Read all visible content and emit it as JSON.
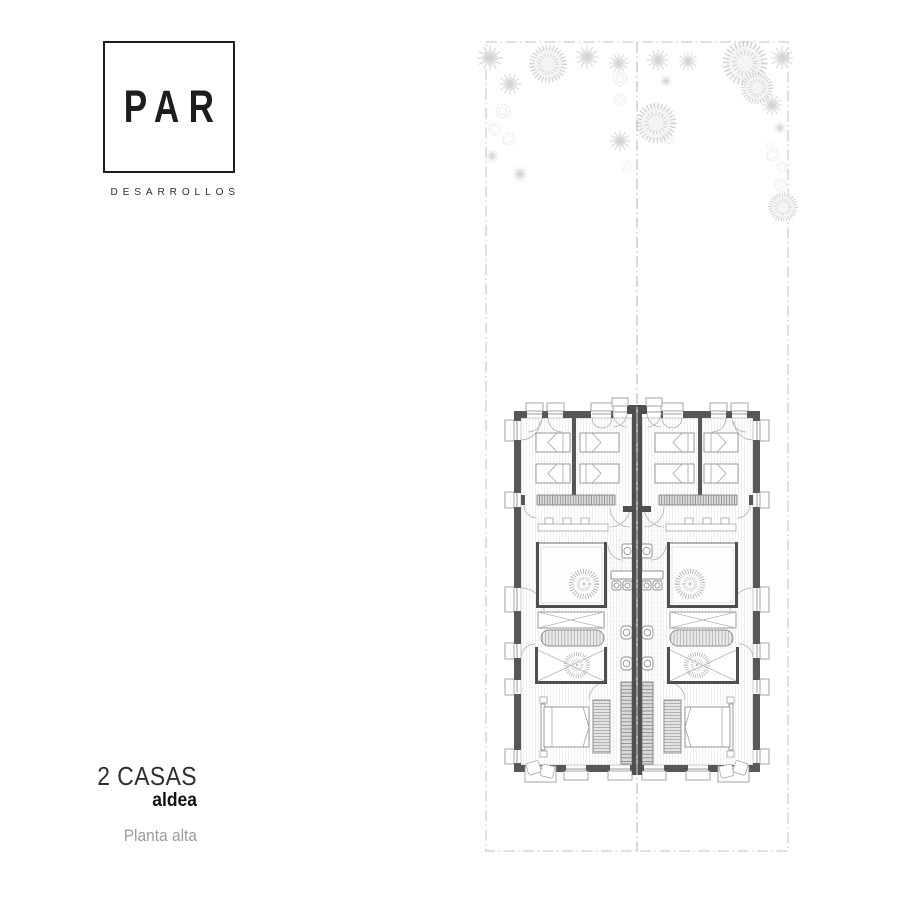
{
  "brand": {
    "name": "PAR",
    "subtitle": "DESARROLLOS"
  },
  "project": {
    "title": "2 CASAS",
    "variant": "aldea",
    "floor_label": "Planta alta"
  },
  "plan": {
    "kind": "architectural floor plan, two mirrored houses (duplex), upper floor",
    "houses": 2
  },
  "colors": {
    "ink": "#1d1d1b",
    "text_muted": "#9c9c9c",
    "wall_dark": "#575757",
    "wall_accent": "#4f4f4f",
    "hatch_light": "#dedede",
    "vegetation": "#d5d5d5",
    "boundary_dash": "#c0c0c0"
  }
}
